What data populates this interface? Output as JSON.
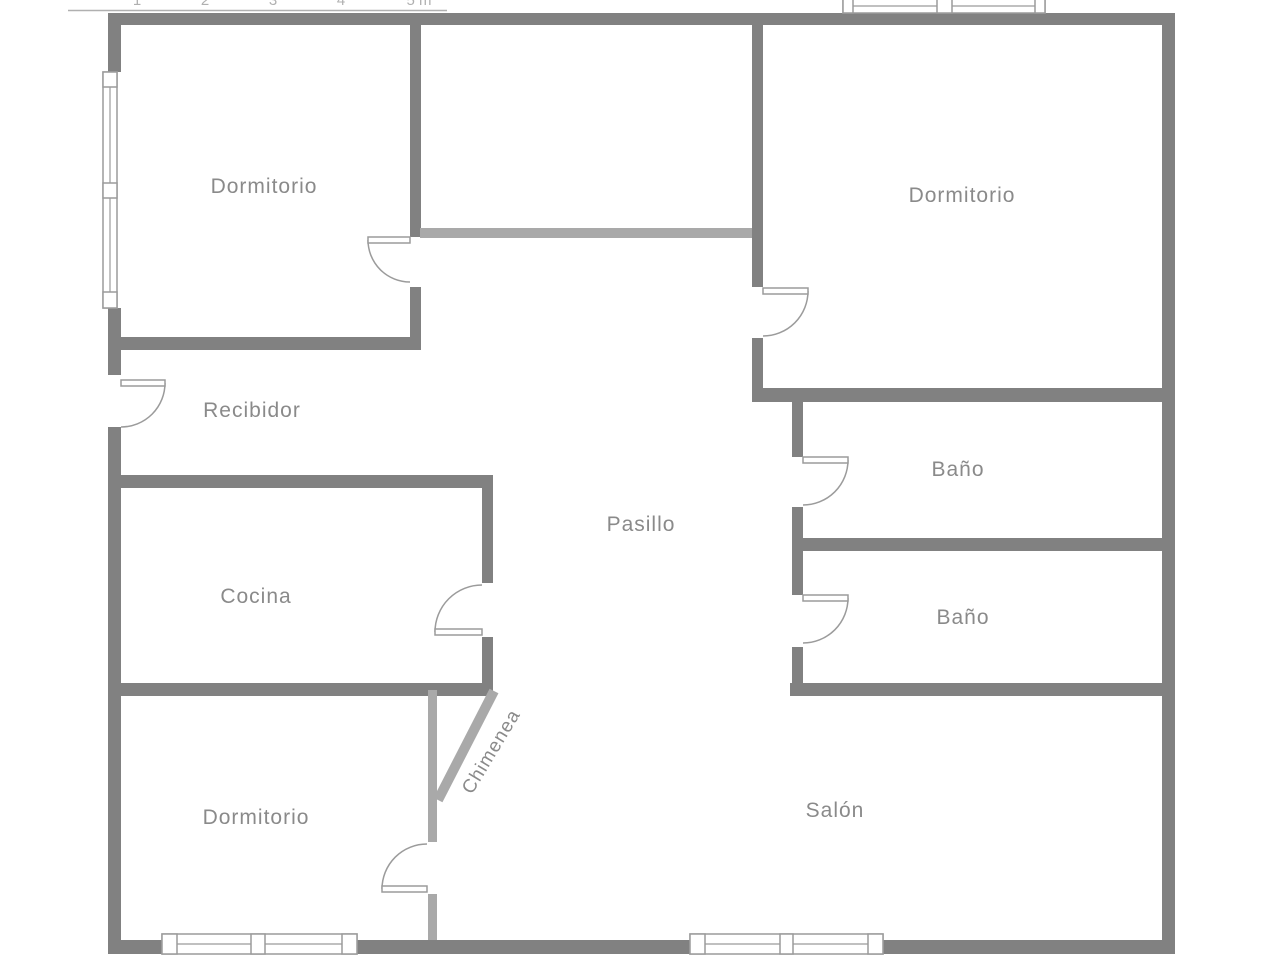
{
  "scale_bar": {
    "ticks": [
      "1",
      "2",
      "3",
      "4",
      "5 m"
    ]
  },
  "rooms": {
    "dormitorio_tl": "Dormitorio",
    "dormitorio_tr": "Dormitorio",
    "recibidor": "Recibidor",
    "pasillo": "Pasillo",
    "cocina": "Cocina",
    "bano_1": "Baño",
    "bano_2": "Baño",
    "dormitorio_bl": "Dormitorio",
    "salon": "Salón",
    "chimenea": "Chimenea"
  },
  "colors": {
    "background": "#ffffff",
    "wall": "#818181",
    "wall_light": "#a9a9a9",
    "door_window": "#9b9b9b",
    "label_text": "#8a8a8a",
    "ruler": "#b0b0b0"
  }
}
